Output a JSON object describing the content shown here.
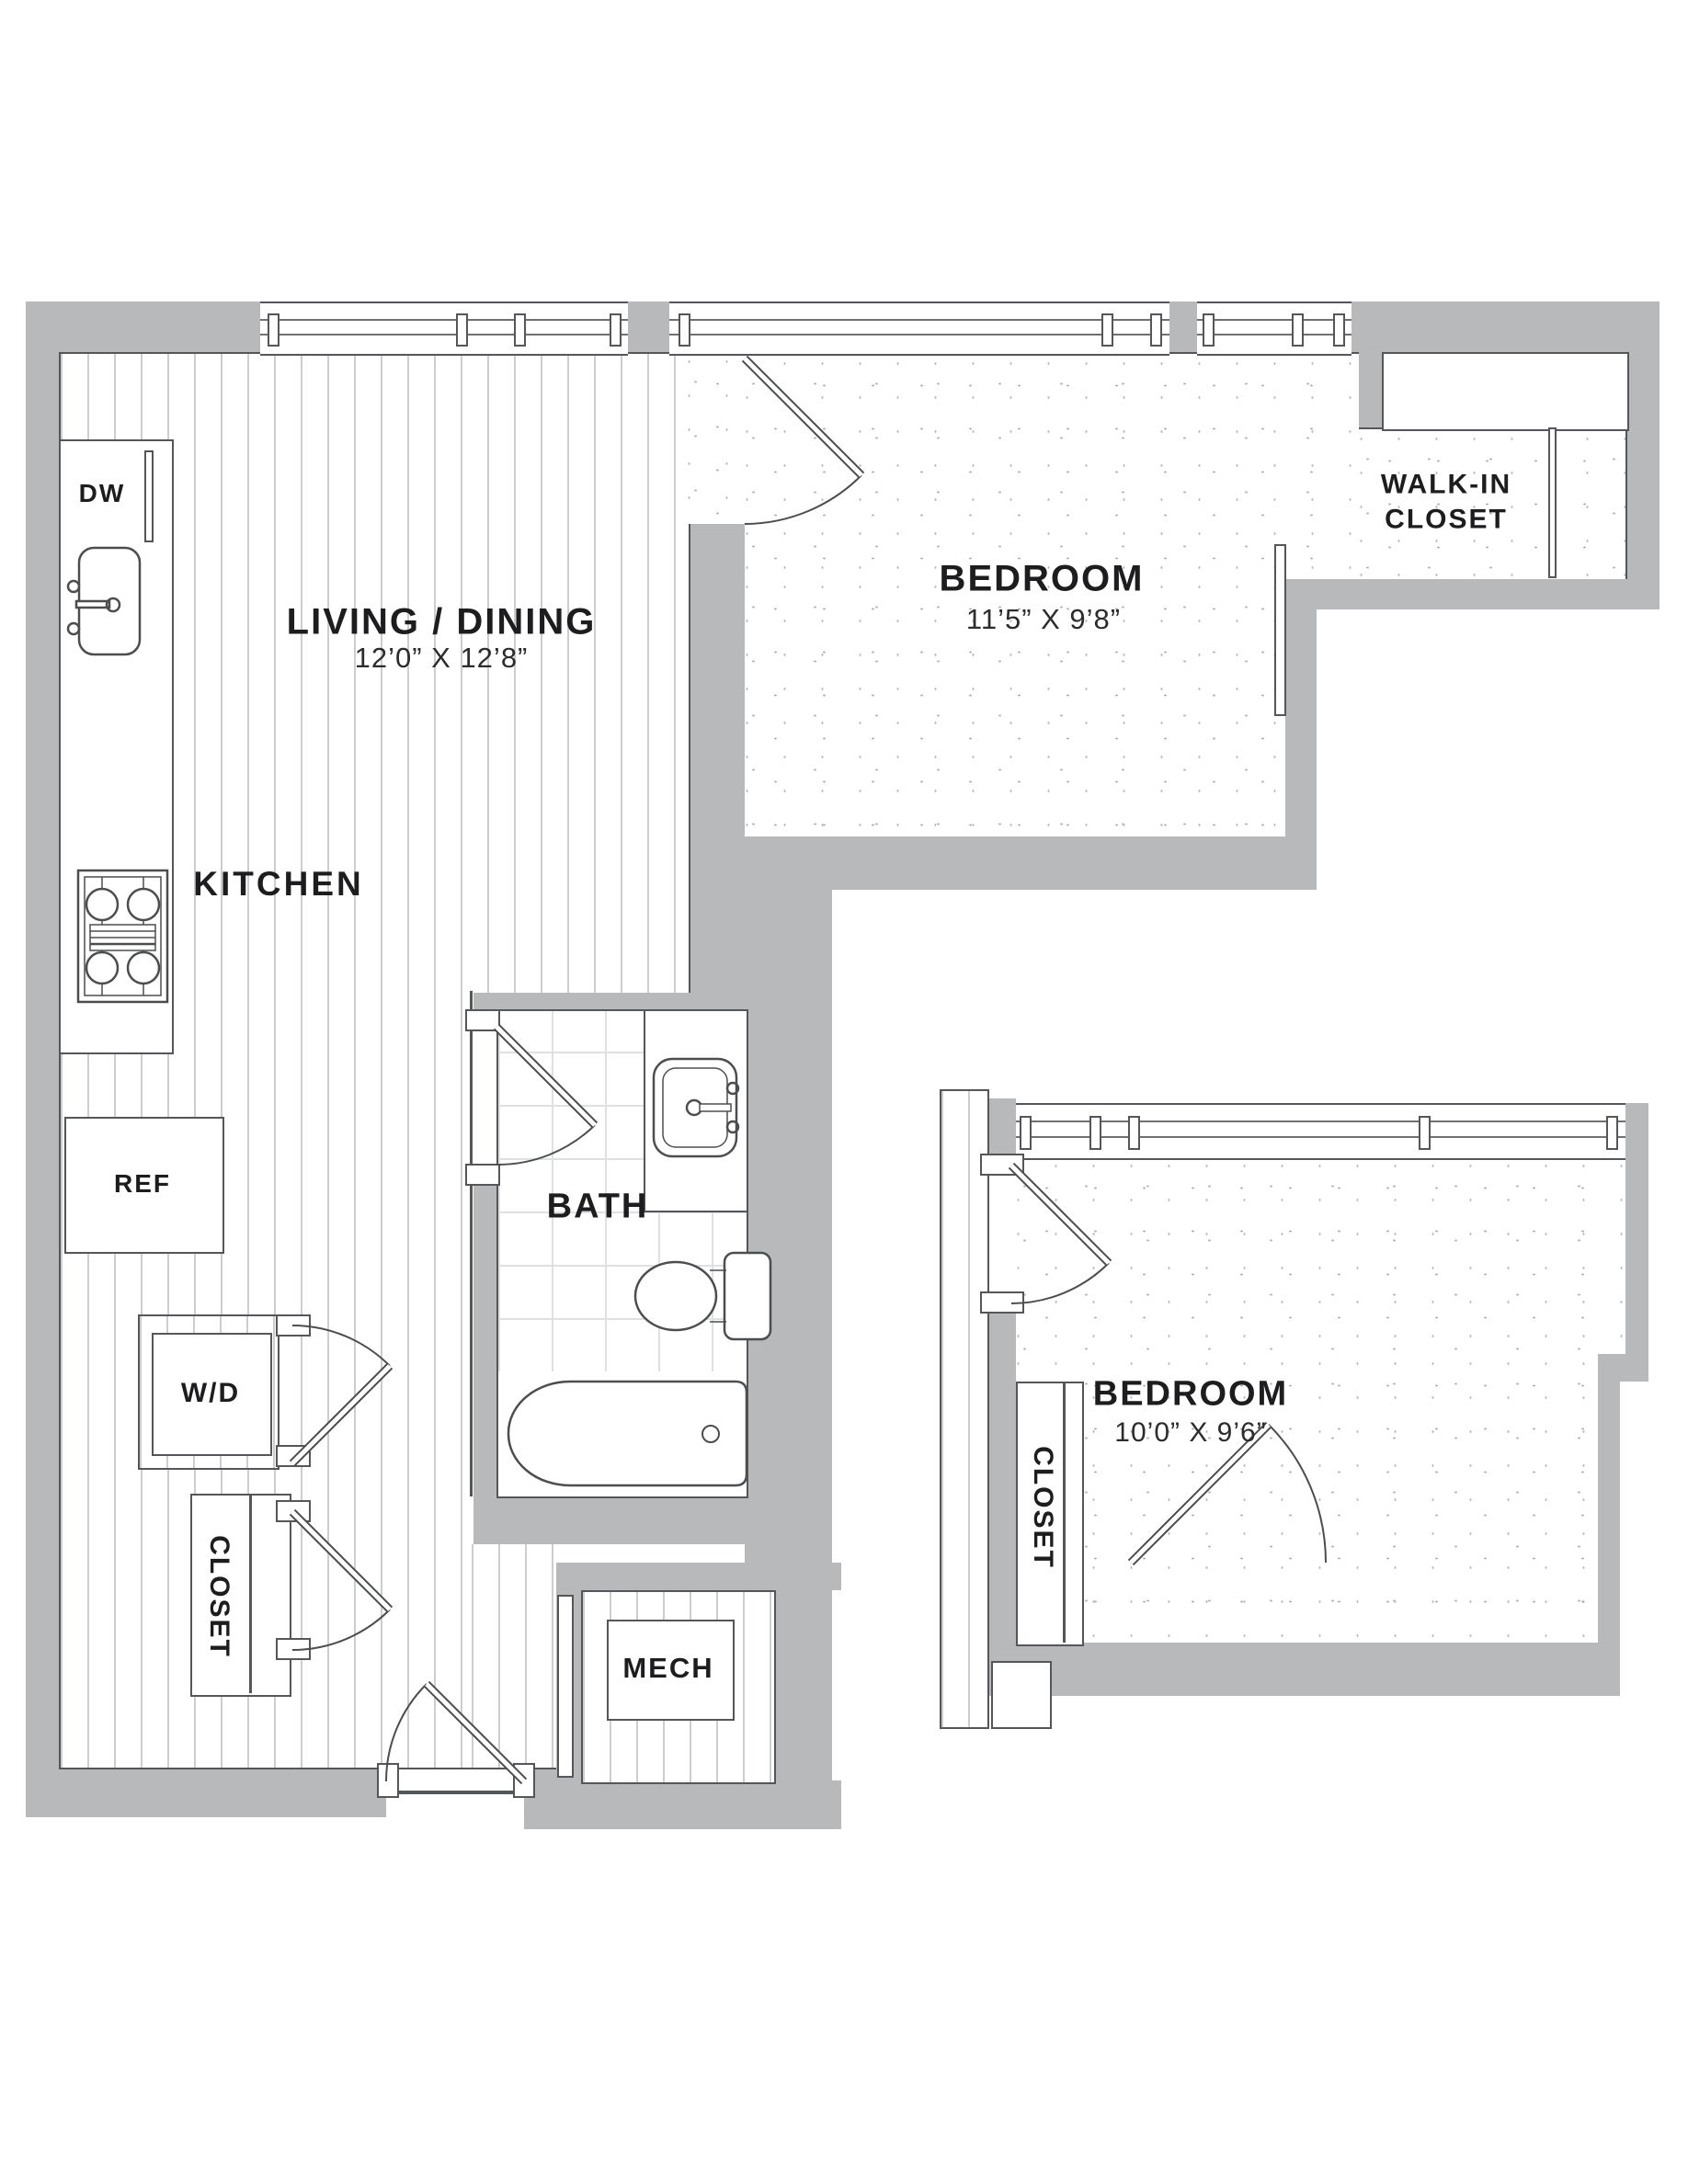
{
  "plan_title": "Floor Plan",
  "rooms": {
    "living": {
      "name": "LIVING / DINING",
      "dims": "12’0” X 12’8”"
    },
    "kitchen": {
      "name": "KITCHEN"
    },
    "bedroom1": {
      "name": "BEDROOM",
      "dims": "11’5” X 9’8”"
    },
    "walk_in_closet": {
      "name": "WALK-IN CLOSET"
    },
    "bath": {
      "name": "BATH"
    },
    "washer_dryer": {
      "name": "W/D"
    },
    "closet1": {
      "name": "CLOSET"
    },
    "mech": {
      "name": "MECH"
    },
    "bedroom2": {
      "name": "BEDROOM",
      "dims": "10’0” X 9’6”"
    },
    "closet2": {
      "name": "CLOSET"
    }
  },
  "appliances": {
    "dishwasher": "DW",
    "refrigerator": "REF"
  },
  "colors": {
    "wall": "#b7b9bb",
    "line": "#54565a",
    "text": "#1d1d1f"
  }
}
